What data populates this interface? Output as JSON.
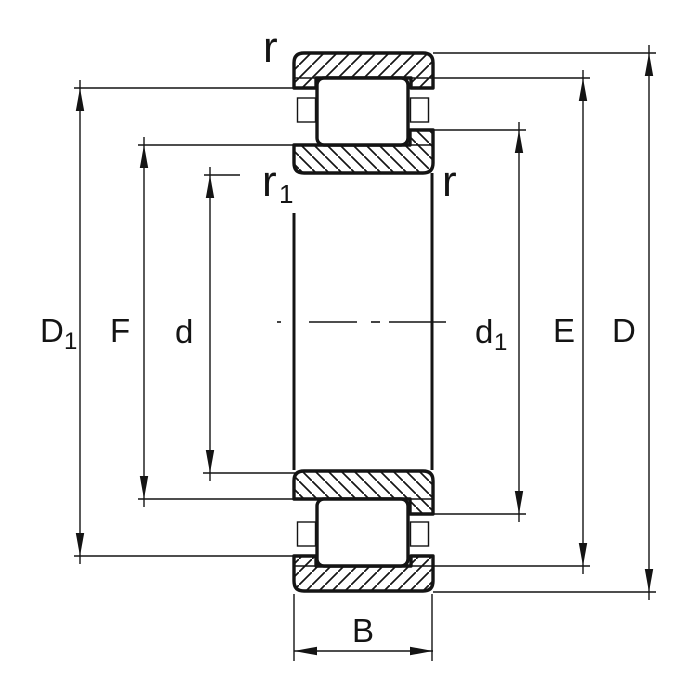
{
  "diagram": {
    "kind": "cylindrical-roller-bearing-cross-section",
    "colors": {
      "line": "#141414",
      "background": "#ffffff"
    },
    "labels": {
      "D1": {
        "main": "D",
        "sub": "1"
      },
      "F": "F",
      "d": "d",
      "d1": {
        "main": "d",
        "sub": "1"
      },
      "E": "E",
      "D": "D",
      "B": "B",
      "r_top": "r",
      "r1": {
        "main": "r",
        "sub": "1"
      },
      "r_right": "r"
    }
  }
}
